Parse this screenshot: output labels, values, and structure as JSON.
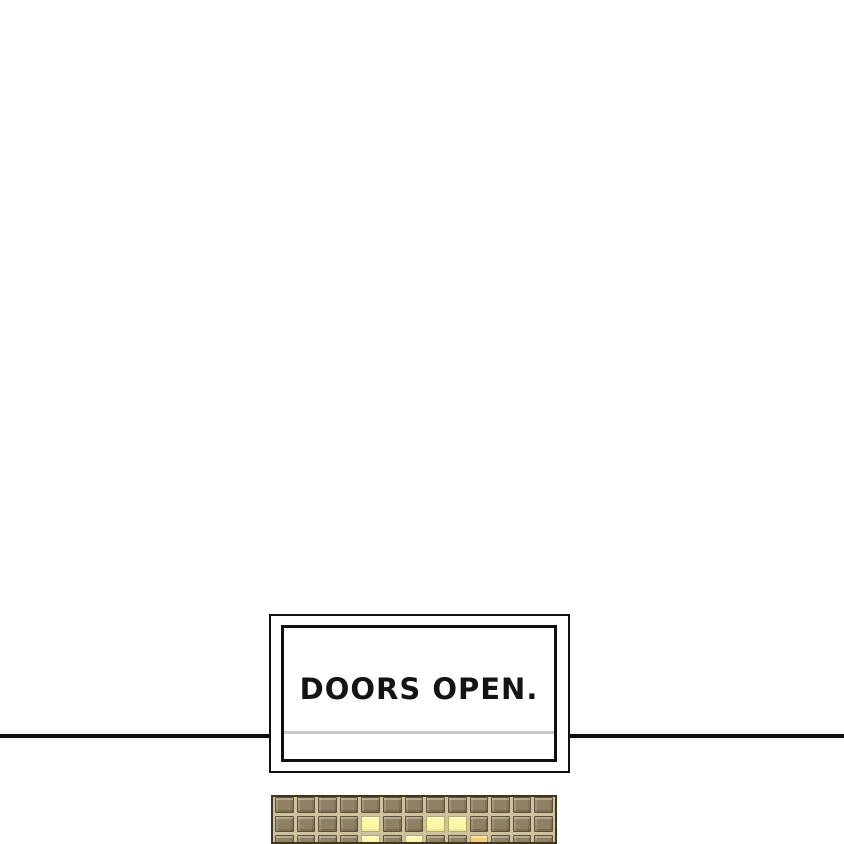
{
  "caption": {
    "text": "DOORS OPEN."
  },
  "divider": {
    "color": "#0d0d0d"
  },
  "caption_box": {
    "border_color": "#101010",
    "underline_color": "#c6c6c6",
    "background": "#ffffff"
  },
  "tile_panel": {
    "rows": 3,
    "columns": 13,
    "colors": {
      "grout": "#cfc29e",
      "tile": "#8f8164",
      "tile_outline": "#5f5238",
      "lit": "#fbf7a5",
      "lit_gold": "#f2cf78",
      "panel_border": "#43361f"
    },
    "lit_tiles": [
      {
        "row": 2,
        "col": 5,
        "type": "lit"
      },
      {
        "row": 2,
        "col": 8,
        "type": "lit"
      },
      {
        "row": 2,
        "col": 9,
        "type": "lit"
      },
      {
        "row": 3,
        "col": 5,
        "type": "lit"
      },
      {
        "row": 3,
        "col": 7,
        "type": "lit"
      },
      {
        "row": 3,
        "col": 10,
        "type": "gold"
      }
    ]
  }
}
